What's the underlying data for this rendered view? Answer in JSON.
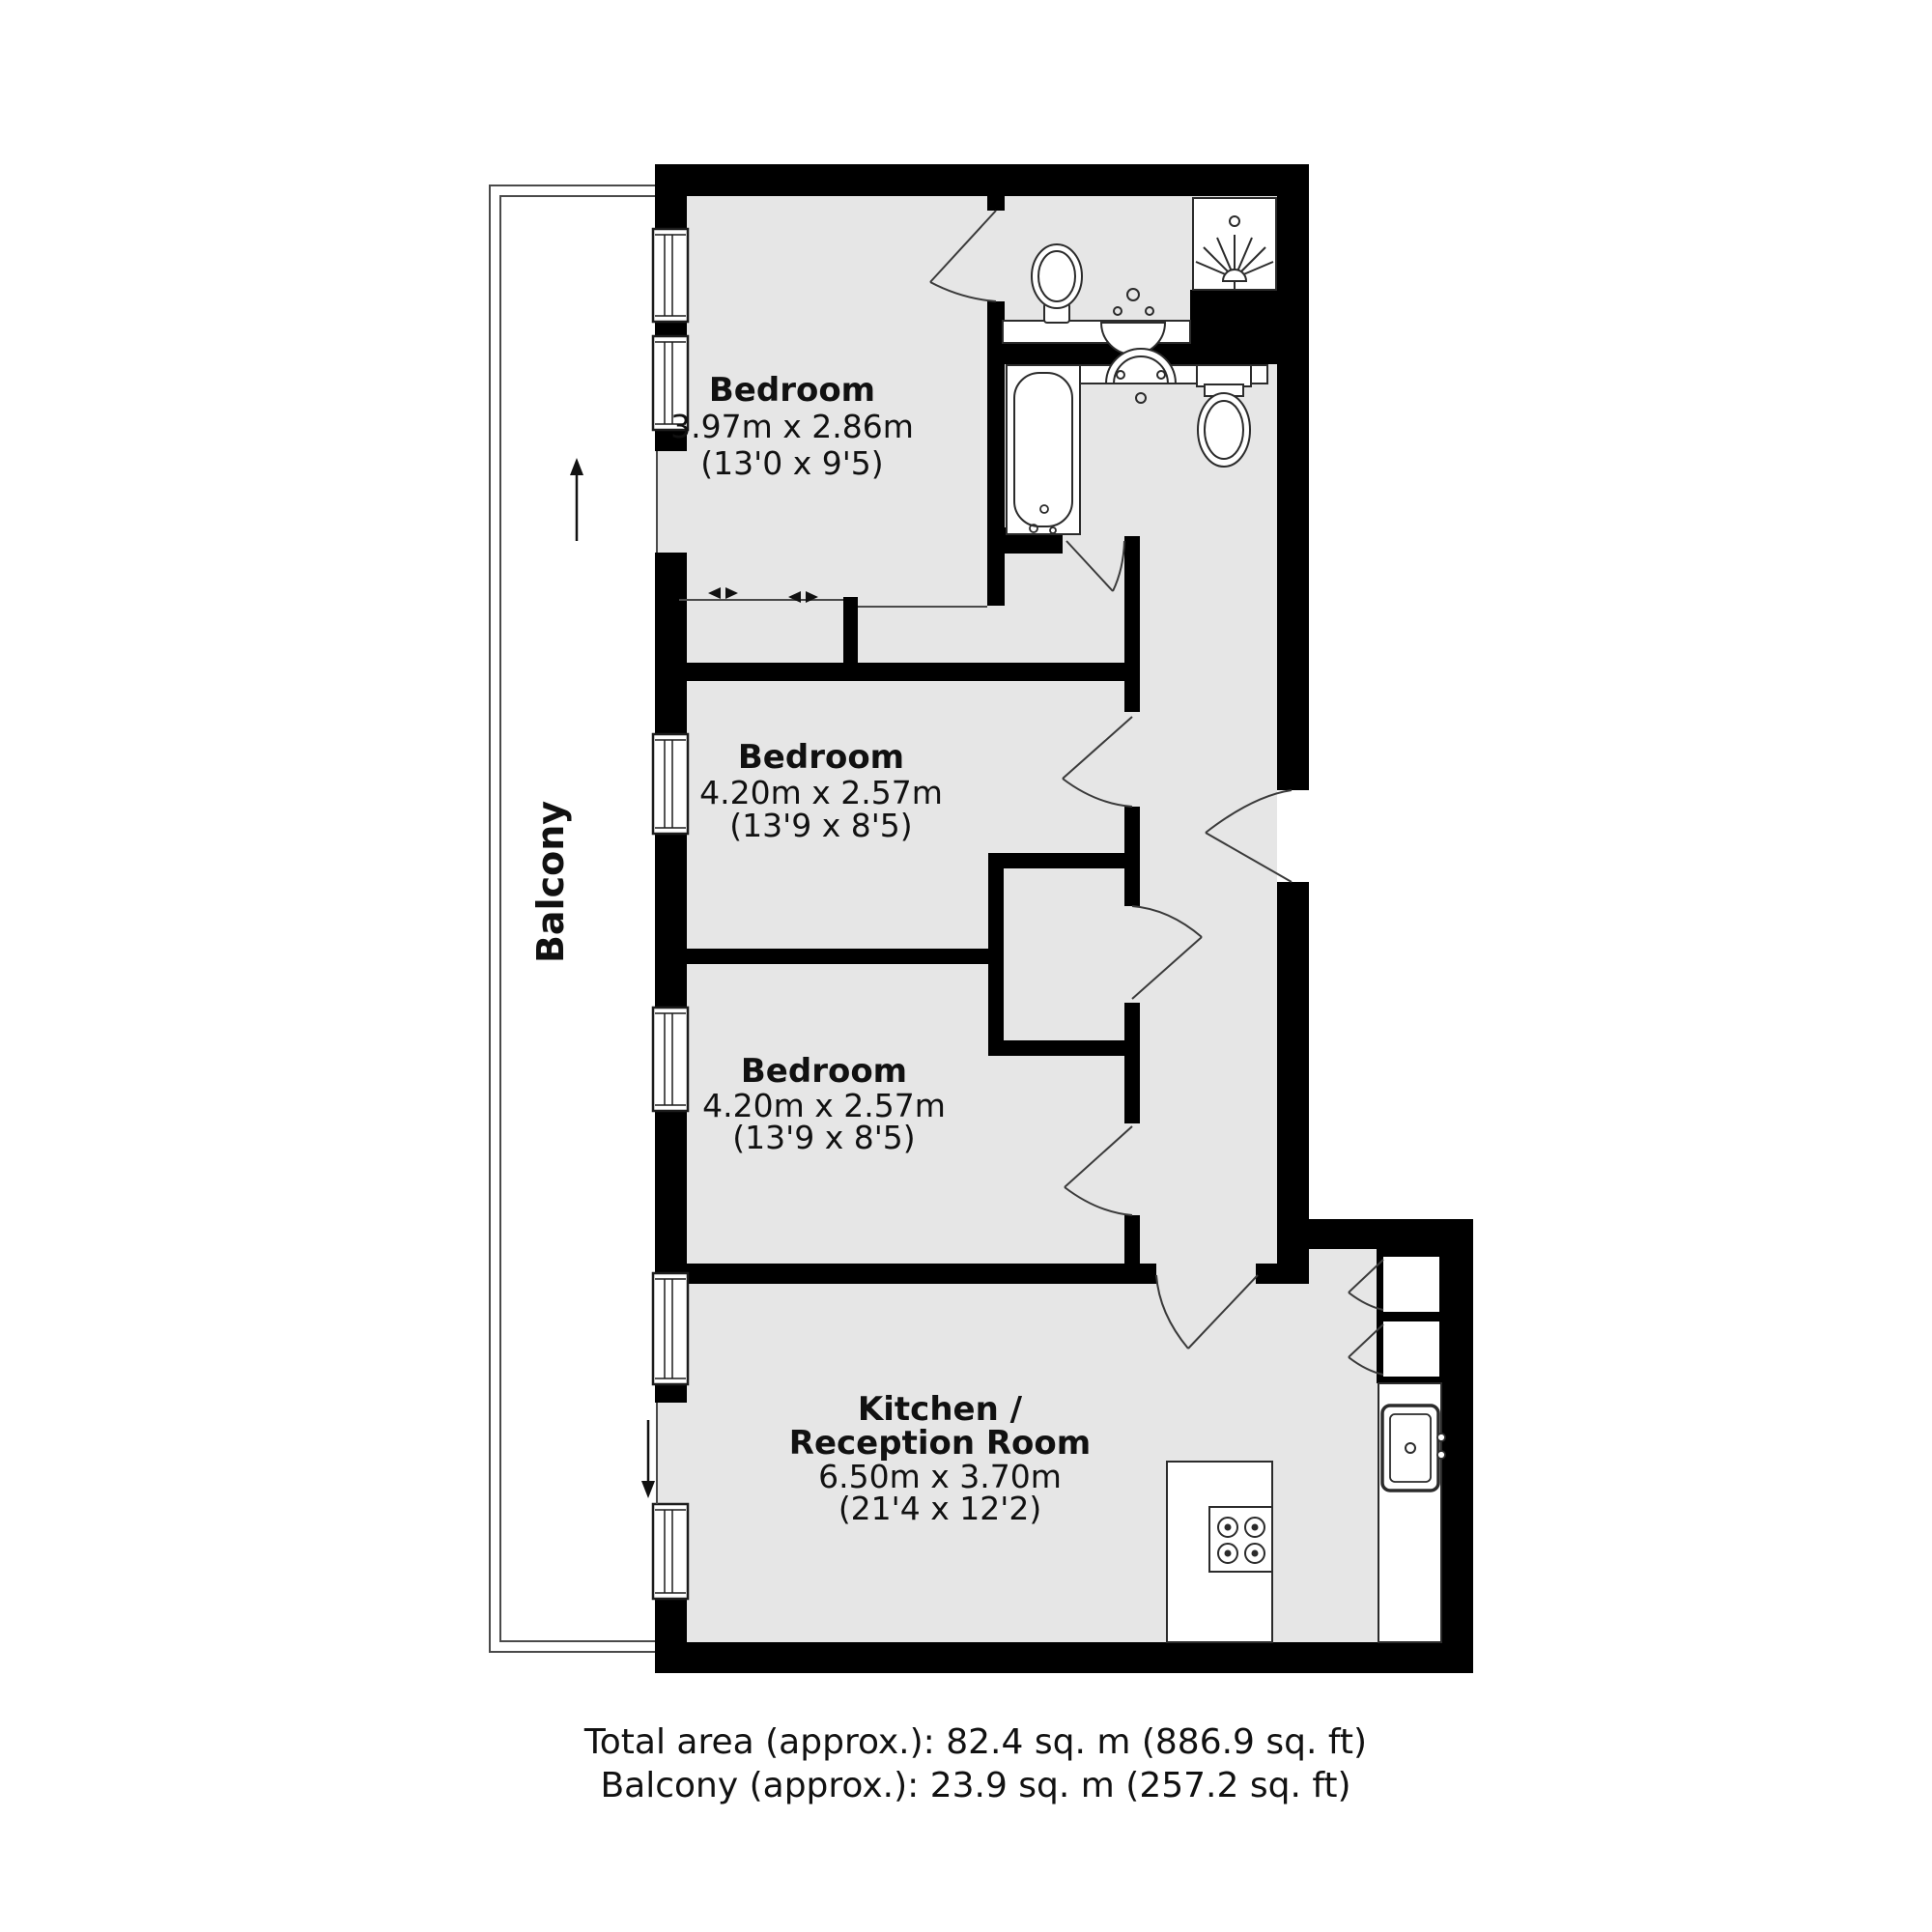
{
  "plan": {
    "type": "apartment-floor-plan",
    "rooms": {
      "bedroom1": {
        "name": "Bedroom",
        "metric": "3.97m x 2.86m",
        "imperial": "(13'0 x 9'5)"
      },
      "bedroom2": {
        "name": "Bedroom",
        "metric": "4.20m x 2.57m",
        "imperial": "(13'9 x 8'5)"
      },
      "bedroom3": {
        "name": "Bedroom",
        "metric": "4.20m x 2.57m",
        "imperial": "(13'9 x 8'5)"
      },
      "kitchen": {
        "name_line1": "Kitchen /",
        "name_line2": "Reception Room",
        "metric": "6.50m x 3.70m",
        "imperial": "(21'4 x 12'2)"
      }
    },
    "balcony": {
      "label": "Balcony"
    },
    "fixtures": [
      "toilet-icon",
      "sink-icon",
      "shower-icon",
      "bathtub-icon",
      "stove-icon",
      "kitchen-sink-icon",
      "window-icon",
      "sliding-door-arrows-icon",
      "door-swing-icon"
    ],
    "colors": {
      "wall": "#000000",
      "floor": "#e6e6e6",
      "line": "#3a3a3a",
      "fixture_fill": "#ffffff",
      "text": "#111111",
      "background": "#ffffff"
    }
  },
  "footer": {
    "line1": "Total area (approx.): 82.4 sq. m (886.9 sq. ft)",
    "line2": "Balcony (approx.): 23.9 sq. m (257.2 sq. ft)"
  }
}
